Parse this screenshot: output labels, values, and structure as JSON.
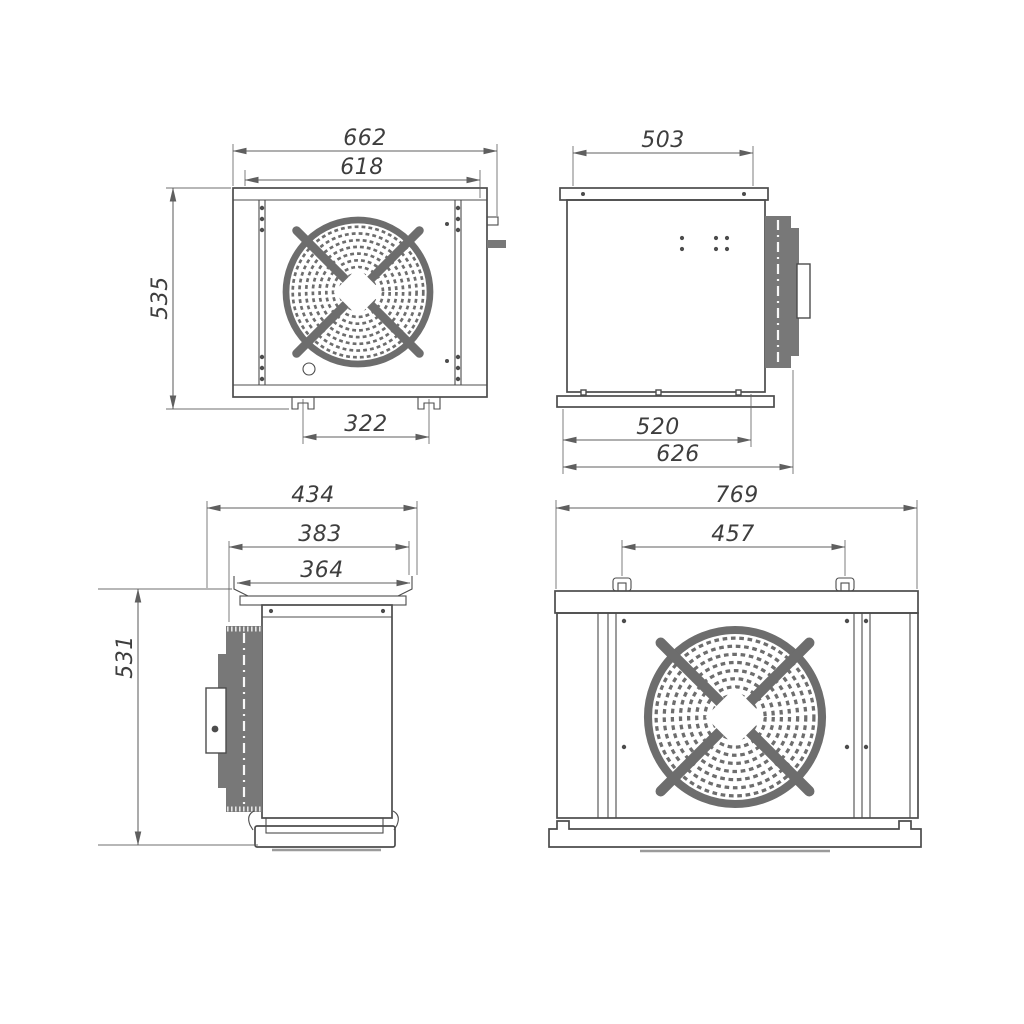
{
  "colors": {
    "bg": "#ffffff",
    "line": "#4c4c4c",
    "dim": "#5f5f5f",
    "grille": "#6d6d6d",
    "coil": "#787878",
    "text": "#3e3e3e"
  },
  "drawing": {
    "views": {
      "unit1_front": {
        "dims": {
          "overall_width": "662",
          "body_width": "618",
          "overall_height": "535",
          "feet_spacing": "322"
        }
      },
      "unit1_side": {
        "dims": {
          "top_depth": "503",
          "base_depth": "520",
          "overall_depth": "626"
        }
      },
      "unit2_side": {
        "dims": {
          "overall_depth": "434",
          "plate_depth": "383",
          "plate_inner_depth": "364",
          "overall_height": "531"
        }
      },
      "unit2_front": {
        "dims": {
          "overall_width": "769",
          "hook_spacing": "457"
        }
      }
    }
  }
}
